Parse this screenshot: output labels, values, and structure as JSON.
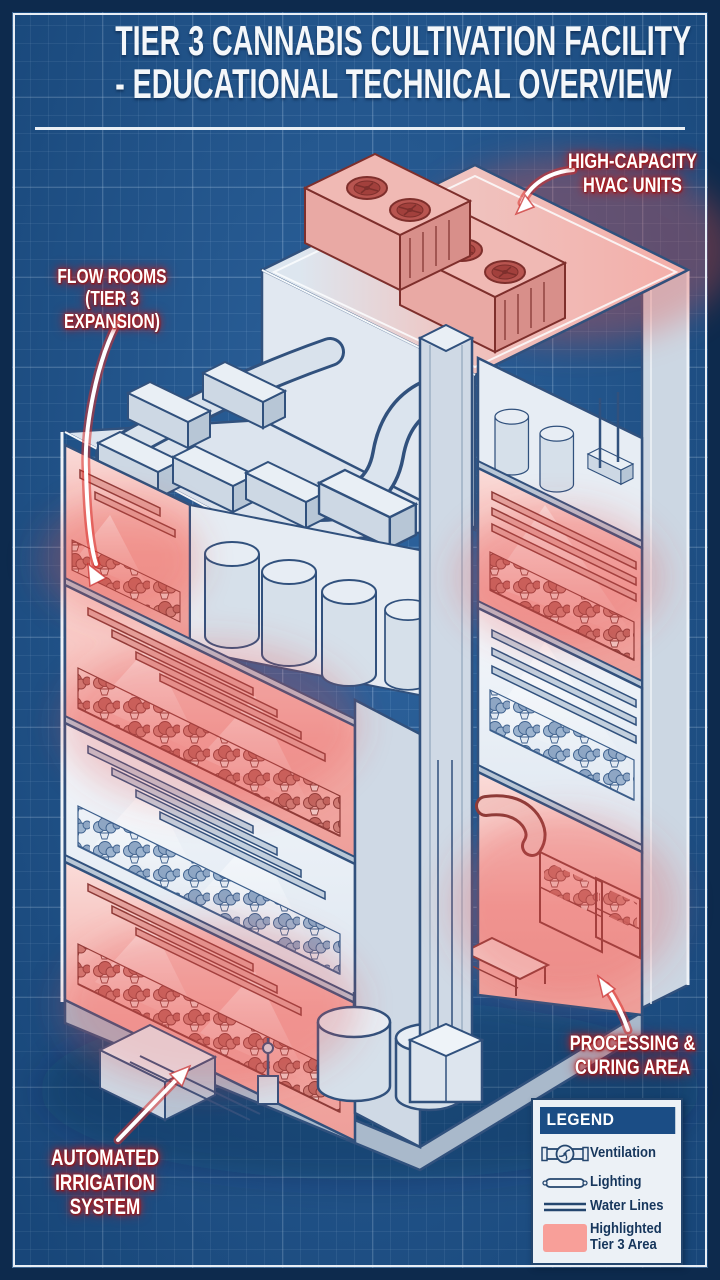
{
  "title": {
    "line1": "TIER 3 CANNABIS CULTIVATION FACILITY",
    "line2": "- EDUCATIONAL TECHNICAL OVERVIEW"
  },
  "callouts": {
    "hvac": "HIGH-CAPACITY\nHVAC UNITS",
    "flow_rooms": "FLOW ROOMS\n(TIER 3 EXPANSION)",
    "irrigation": "AUTOMATED\nIRRIGATION\nSYSTEM",
    "processing": "PROCESSING &\nCURING AREA"
  },
  "legend": {
    "title": "LEGEND",
    "items": [
      {
        "icon": "ventilation-icon",
        "label": "Ventilation"
      },
      {
        "icon": "lighting-icon",
        "label": "Lighting"
      },
      {
        "icon": "water-lines-icon",
        "label": "Water Lines"
      },
      {
        "icon": "tier3-area-swatch",
        "label": "Highlighted\nTier 3 Area"
      }
    ]
  },
  "colors": {
    "background_blue": "#1e5897",
    "frame_navy": "#0d2a4d",
    "frame_white": "#e8eef5",
    "structure_line": "#31517d",
    "structure_fill": "#d7e0ea",
    "highlight_red": "#f3aaa5",
    "glow_red": "#e8514a",
    "plant_red": "#c1645e",
    "plant_blue": "#8ea6c4",
    "legend_header_blue": "#1b4d85"
  }
}
